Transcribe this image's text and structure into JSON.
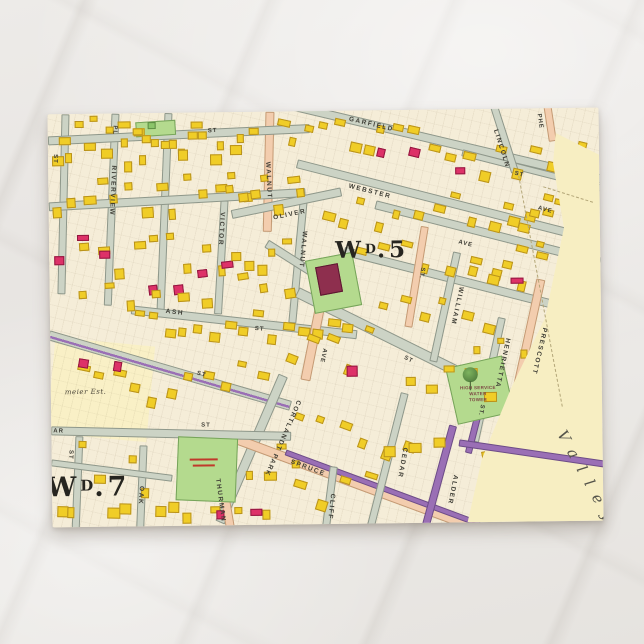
{
  "postcard": {
    "description_note": "vintage ward atlas map postcard on marble surface"
  },
  "map": {
    "wards": {
      "ward5": {
        "prefix": "W",
        "sup": "D",
        "suffix": ".5"
      },
      "ward7": {
        "prefix": "W",
        "sup": "D",
        "suffix": ".7"
      }
    },
    "streets": {
      "garfield": "GARFIELD",
      "webster": "WEBSTER",
      "lincoln": "LINCOLN",
      "oliver": "OLIVER",
      "walnut": "WALNUT",
      "victor": "VICTOR",
      "riverview": "RIVERVIEW",
      "pl": "PL",
      "ash": "ASH",
      "william": "WILLIAM",
      "henrietta": "HENRIETTA",
      "prescott": "PRESCOTT",
      "spruce": "SPRUCE",
      "cedar": "CEDAR",
      "alder": "ALDER",
      "cliff": "CLIFF",
      "oak": "OAK",
      "thurman": "THURMAN",
      "cortlandt_park": "CORTLANDT PARK",
      "st": "ST",
      "st_dot": "ST.",
      "ave": "AVE",
      "phe_partial": "PHE",
      "ar_partial": "AR"
    },
    "places": {
      "estate": "meier Est.",
      "valley": "Valley",
      "water_tower": [
        "HIGH SERVICE",
        "WATER",
        "TOWER"
      ]
    },
    "building_clusters": [
      {
        "x": 2,
        "y": 2,
        "w": 100,
        "h": 55,
        "n": 12,
        "c": "y"
      },
      {
        "x": 75,
        "y": 4,
        "w": 85,
        "h": 50,
        "n": 9,
        "c": "y"
      },
      {
        "x": 130,
        "y": 2,
        "w": 80,
        "h": 48,
        "n": 8,
        "c": "y"
      },
      {
        "x": 4,
        "y": 55,
        "w": 200,
        "h": 50,
        "n": 14,
        "c": "y",
        "r": -3
      },
      {
        "x": 30,
        "y": 115,
        "w": 150,
        "h": 50,
        "n": 9,
        "c": "y",
        "r": -3
      },
      {
        "x": 4,
        "y": 120,
        "w": 55,
        "h": 40,
        "n": 3,
        "c": "r"
      },
      {
        "x": 178,
        "y": 55,
        "w": 80,
        "h": 50,
        "n": 7,
        "c": "y",
        "r": -6
      },
      {
        "x": 100,
        "y": 140,
        "w": 80,
        "h": 45,
        "n": 4,
        "c": "r",
        "r": -6
      },
      {
        "x": 182,
        "y": 120,
        "w": 60,
        "h": 45,
        "n": 5,
        "c": "y"
      },
      {
        "x": 228,
        "y": 4,
        "w": 140,
        "h": 45,
        "n": 10,
        "c": "y",
        "r": 13
      },
      {
        "x": 380,
        "y": 30,
        "w": 160,
        "h": 40,
        "n": 10,
        "c": "y",
        "r": 14
      },
      {
        "x": 330,
        "y": 28,
        "w": 40,
        "h": 25,
        "n": 2,
        "c": "r",
        "r": 14
      },
      {
        "x": 272,
        "y": 80,
        "w": 250,
        "h": 45,
        "n": 14,
        "c": "y",
        "r": 15
      },
      {
        "x": 305,
        "y": 130,
        "w": 215,
        "h": 40,
        "n": 10,
        "c": "y",
        "r": 15
      },
      {
        "x": 85,
        "y": 195,
        "w": 215,
        "h": 40,
        "n": 15,
        "c": "y",
        "r": 7
      },
      {
        "x": 25,
        "y": 248,
        "w": 190,
        "h": 45,
        "n": 11,
        "c": "y",
        "r": 12
      },
      {
        "x": 28,
        "y": 238,
        "w": 45,
        "h": 20,
        "n": 2,
        "c": "r",
        "r": 10
      },
      {
        "x": 235,
        "y": 215,
        "w": 90,
        "h": 50,
        "n": 5,
        "c": "y",
        "r": 22
      },
      {
        "x": 330,
        "y": 180,
        "w": 110,
        "h": 50,
        "n": 6,
        "c": "y",
        "r": 15
      },
      {
        "x": 420,
        "y": 140,
        "w": 75,
        "h": 40,
        "n": 5,
        "c": "y",
        "r": 14
      },
      {
        "x": 455,
        "y": 90,
        "w": 60,
        "h": 45,
        "n": 5,
        "c": "y",
        "r": 14
      },
      {
        "x": 4,
        "y": 318,
        "w": 120,
        "h": 85,
        "n": 10,
        "c": "y",
        "r": 2
      },
      {
        "x": 130,
        "y": 392,
        "w": 90,
        "h": 16,
        "n": 4,
        "c": "y"
      },
      {
        "x": 195,
        "y": 330,
        "w": 55,
        "h": 55,
        "n": 4,
        "c": "y"
      },
      {
        "x": 245,
        "y": 295,
        "w": 115,
        "h": 55,
        "n": 6,
        "c": "y",
        "r": 21
      },
      {
        "x": 355,
        "y": 250,
        "w": 85,
        "h": 45,
        "n": 5,
        "c": "y"
      },
      {
        "x": 425,
        "y": 225,
        "w": 55,
        "h": 30,
        "n": 3,
        "c": "y"
      },
      {
        "x": 165,
        "y": 395,
        "w": 40,
        "h": 14,
        "n": 2,
        "c": "r"
      },
      {
        "x": 400,
        "y": 55,
        "w": 28,
        "h": 18,
        "n": 1,
        "c": "r"
      },
      {
        "x": 452,
        "y": 168,
        "w": 26,
        "h": 16,
        "n": 1,
        "c": "r"
      },
      {
        "x": 288,
        "y": 248,
        "w": 26,
        "h": 16,
        "n": 1,
        "c": "r"
      },
      {
        "x": 92,
        "y": 8,
        "w": 30,
        "h": 12,
        "n": 1,
        "c": "g"
      },
      {
        "x": 430,
        "y": 338,
        "w": 45,
        "h": 25,
        "n": 3,
        "c": "y",
        "r": -10
      },
      {
        "x": 30,
        "y": 168,
        "w": 130,
        "h": 28,
        "n": 6,
        "c": "y",
        "r": -3
      },
      {
        "x": 188,
        "y": 158,
        "w": 55,
        "h": 30,
        "n": 3,
        "c": "y",
        "r": -8
      },
      {
        "x": 240,
        "y": 360,
        "w": 80,
        "h": 40,
        "n": 4,
        "c": "y",
        "r": 18
      },
      {
        "x": 330,
        "y": 300,
        "w": 60,
        "h": 45,
        "n": 3,
        "c": "y"
      }
    ]
  },
  "colors": {
    "map_cream": "#f5edd8",
    "valley_cream": "#f7eec2",
    "estate_cream": "#f9f0c6",
    "road_grey": "#ccd3c5",
    "road_pink": "#f3cdae",
    "trolley_purple": "#9a6fb5",
    "building_yellow": "#f0cd27",
    "building_red": "#dd3168",
    "park_green": "#b4da8e"
  }
}
